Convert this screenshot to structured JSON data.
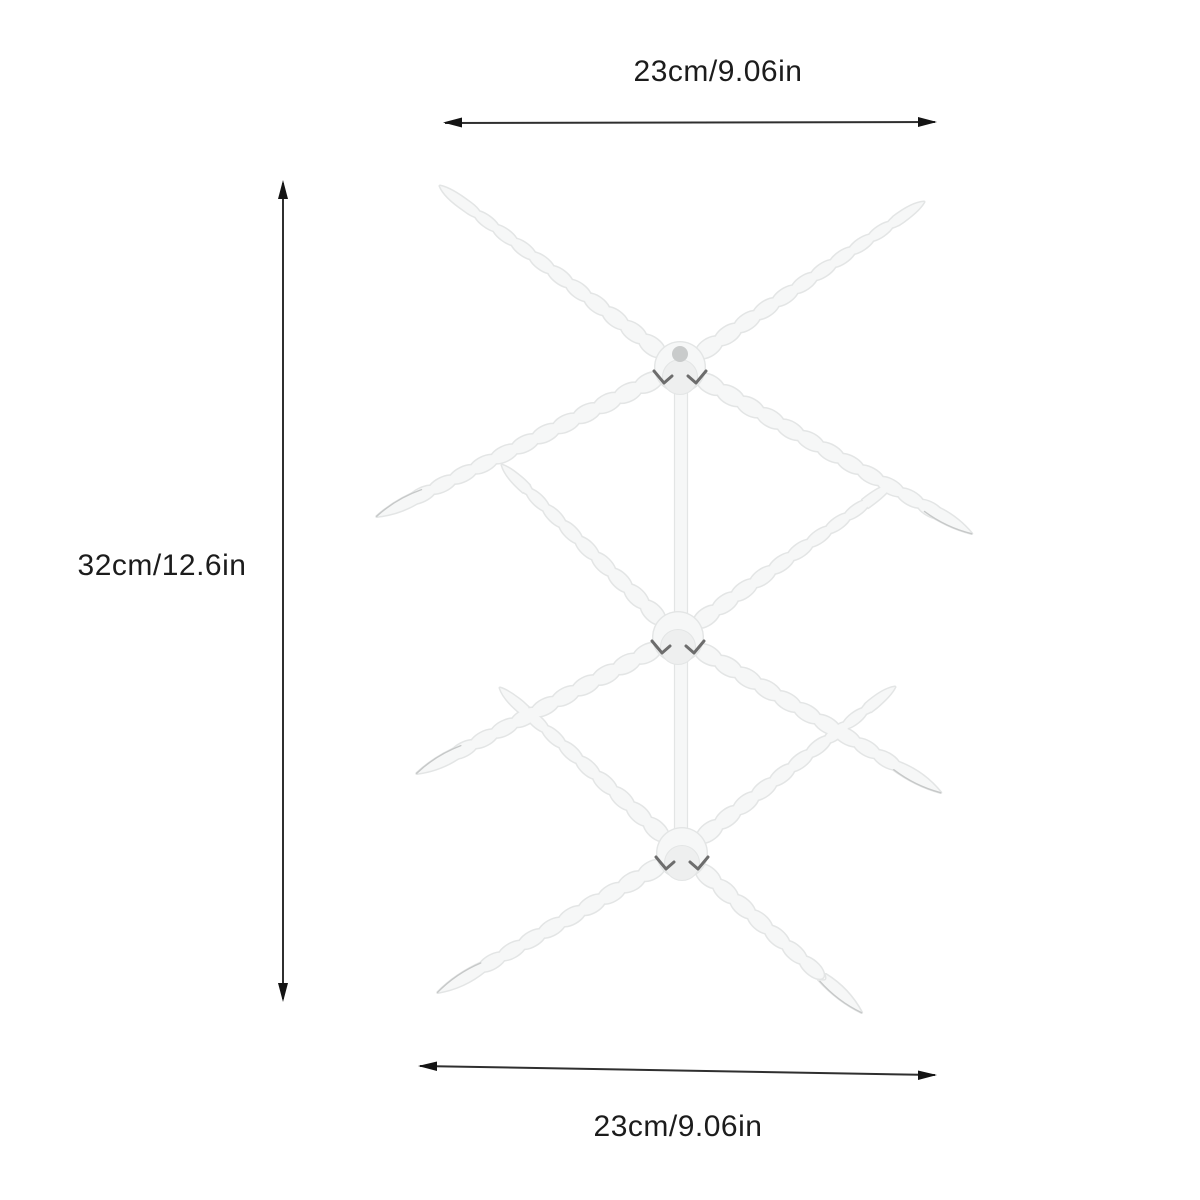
{
  "annotations": {
    "top_width": {
      "label": "23cm/9.06in"
    },
    "height": {
      "label": "32cm/12.6in"
    },
    "bottom_width": {
      "label": "23cm/9.06in"
    }
  },
  "colors": {
    "background": "#ffffff",
    "dimension_line": "#2f2f2f",
    "dimension_arrow": "#141414",
    "dimension_text": "#1c1c1c",
    "product_fill": "#f6f7f7",
    "product_edge": "#e3e5e5",
    "product_shade": "#eeefef",
    "product_shadow_edge": "#c6c8c8",
    "hub_mark": "#6d6d6d",
    "hub_hole": "#c9cbcb"
  },
  "product": {
    "name": "drying-rack-illustration",
    "tiers": 3,
    "pole": {
      "x": 681,
      "y1": 372,
      "y2": 856,
      "width": 13
    },
    "hubs": [
      {
        "x": 680,
        "y": 367,
        "hole": true
      },
      {
        "x": 678,
        "y": 637
      },
      {
        "x": 682,
        "y": 853
      }
    ],
    "arms": [
      {
        "x1": 680,
        "y1": 367,
        "x2": 440,
        "y2": 186,
        "tip": "taper"
      },
      {
        "x1": 680,
        "y1": 367,
        "x2": 924,
        "y2": 202,
        "tip": "taper"
      },
      {
        "x1": 680,
        "y1": 367,
        "x2": 377,
        "y2": 517,
        "tip": "spear"
      },
      {
        "x1": 680,
        "y1": 367,
        "x2": 972,
        "y2": 533,
        "tip": "spear"
      },
      {
        "x1": 678,
        "y1": 637,
        "x2": 502,
        "y2": 465,
        "tip": "taper"
      },
      {
        "x1": 678,
        "y1": 637,
        "x2": 893,
        "y2": 484,
        "tip": "taper"
      },
      {
        "x1": 678,
        "y1": 637,
        "x2": 417,
        "y2": 774,
        "tip": "spear"
      },
      {
        "x1": 678,
        "y1": 637,
        "x2": 941,
        "y2": 792,
        "tip": "spear"
      },
      {
        "x1": 682,
        "y1": 853,
        "x2": 500,
        "y2": 688,
        "tip": "taper"
      },
      {
        "x1": 682,
        "y1": 853,
        "x2": 895,
        "y2": 687,
        "tip": "taper"
      },
      {
        "x1": 682,
        "y1": 853,
        "x2": 438,
        "y2": 993,
        "tip": "spear"
      },
      {
        "x1": 682,
        "y1": 853,
        "x2": 862,
        "y2": 1012,
        "tip": "spear"
      }
    ]
  }
}
